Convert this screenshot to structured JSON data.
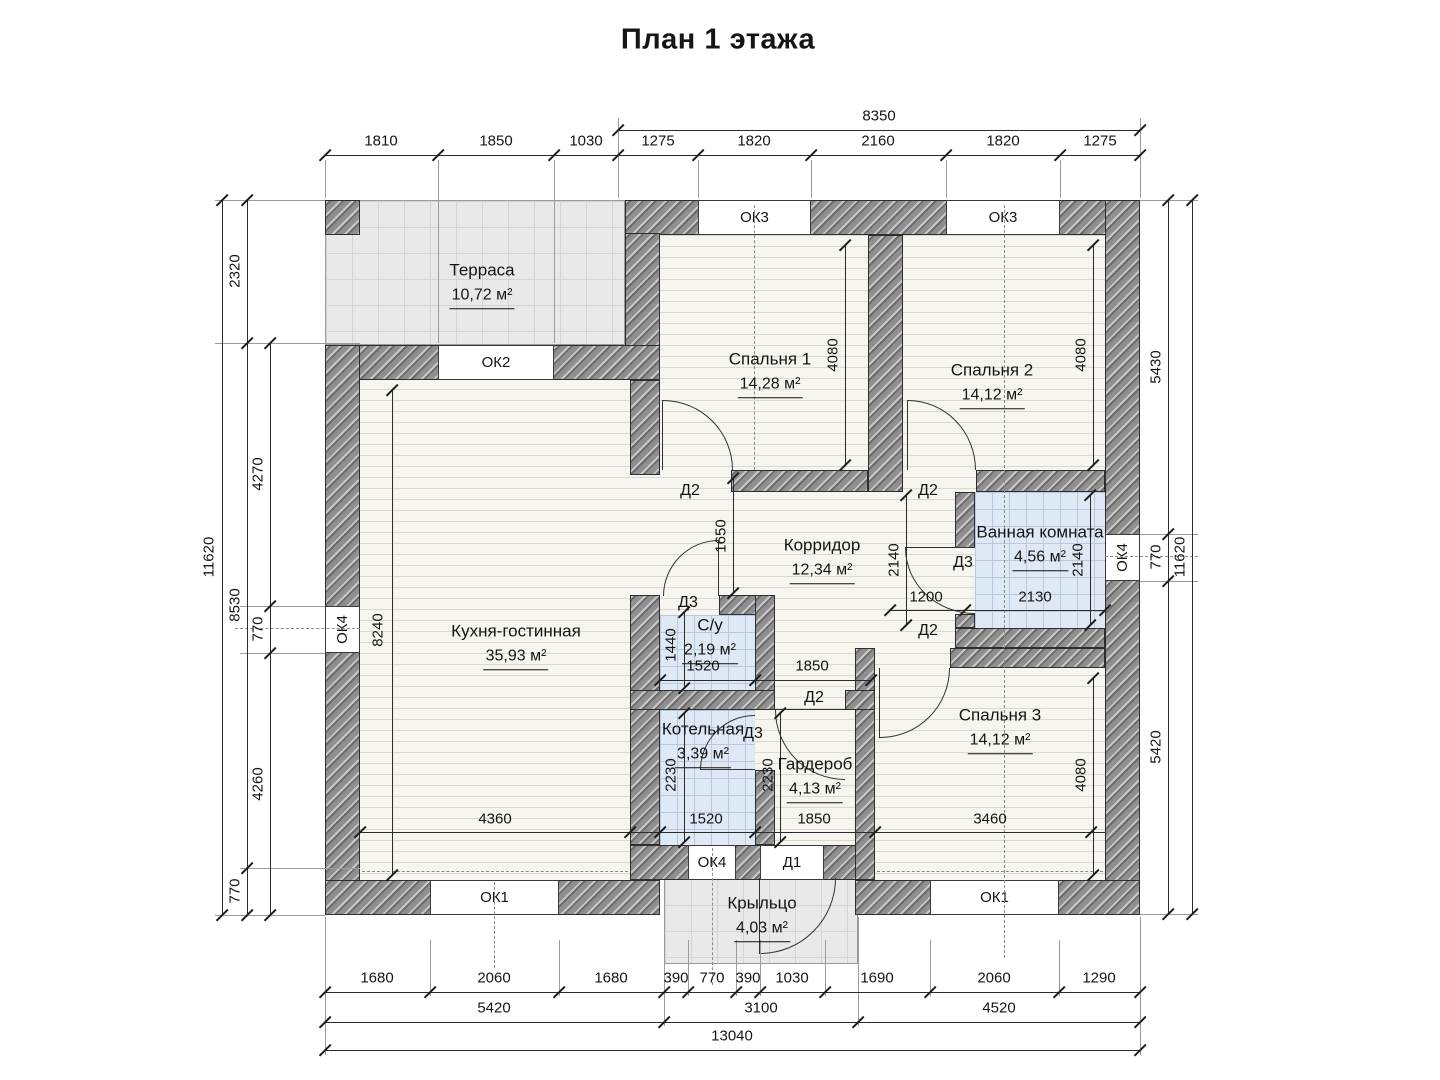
{
  "title": "План 1 этажа",
  "rooms": {
    "terrace": {
      "name": "Терраса",
      "area": "10,72 м²"
    },
    "bedroom1": {
      "name": "Спальня 1",
      "area": "14,28 м²"
    },
    "bedroom2": {
      "name": "Спальня 2",
      "area": "14,12 м²"
    },
    "kitchen": {
      "name": "Кухня-гостинная",
      "area": "35,93 м²"
    },
    "corridor": {
      "name": "Корридор",
      "area": "12,34 м²"
    },
    "bathroom": {
      "name": "Ванная комната",
      "area": "4,56 м²"
    },
    "wc": {
      "name": "С/у",
      "area": "2,19 м²"
    },
    "boiler": {
      "name": "Котельная",
      "area": "3,39 м²"
    },
    "wardrobe": {
      "name": "Гардероб",
      "area": "4,13 м²"
    },
    "bedroom3": {
      "name": "Спальня 3",
      "area": "14,12 м²"
    },
    "porch": {
      "name": "Крыльцо",
      "area": "4,03 м²"
    }
  },
  "windows": {
    "ok1": "ОК1",
    "ok2": "ОК2",
    "ok3": "ОК3",
    "ok4": "ОК4"
  },
  "doors": {
    "d1": "Д1",
    "d2": "Д2",
    "d3": "Д3"
  },
  "dims": {
    "top_total": "8350",
    "top": [
      "1810",
      "1850",
      "1030",
      "1275",
      "1820",
      "2160",
      "1820",
      "1275"
    ],
    "left_outer": "11620",
    "left_mid": [
      "2320",
      "8530",
      "770"
    ],
    "left_inner": [
      "4270",
      "770",
      "4260"
    ],
    "right_inner": [
      "5430",
      "770",
      "5420"
    ],
    "right_outer": "11620",
    "bottom1": [
      "1680",
      "2060",
      "1680",
      "390",
      "770",
      "390",
      "1030",
      "1690",
      "2060",
      "1290"
    ],
    "bottom2": [
      "5420",
      "3100",
      "4520"
    ],
    "bottom_total": "13040",
    "interior": {
      "bedroom1_h": "4080",
      "bedroom2_h": "4080",
      "bedroom3_h": "4080",
      "kitchen_h": "8240",
      "kitchen_w": "4360",
      "opening_h": "1650",
      "corridor_h": "2140",
      "bath_h": "2140",
      "bath_w": "2130",
      "pass_w": "1200",
      "wc_w": "1520",
      "wc_h": "1440",
      "hall_w": "1850",
      "boiler_w": "1520",
      "boiler_h": "2230",
      "wardrobe_h": "2230",
      "wardrobe_w": "1850",
      "bedroom3_w": "3460"
    }
  }
}
